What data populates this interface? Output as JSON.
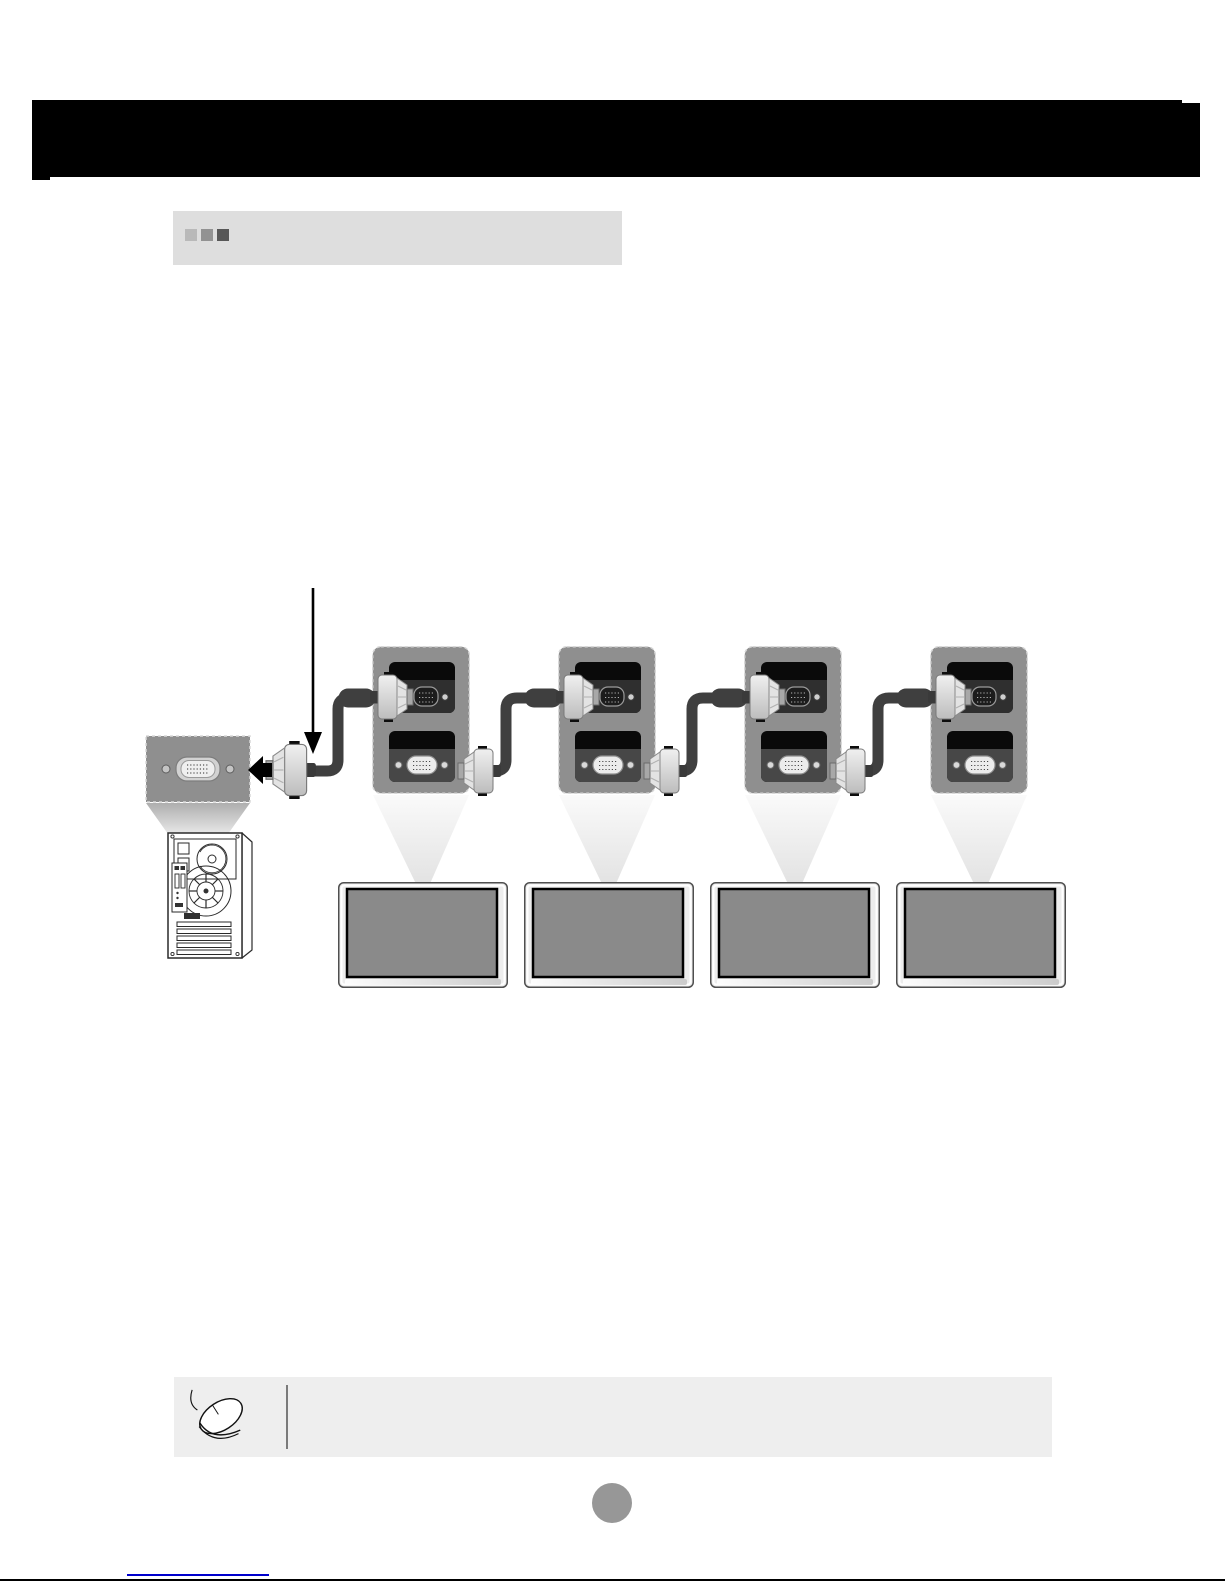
{
  "page": {
    "width": 1225,
    "height": 1585,
    "background": "#ffffff"
  },
  "header": {
    "title": "",
    "background": "#000000"
  },
  "section_heading": {
    "text": "",
    "background": "#dedede",
    "marker_squares": [
      "#b9b9b9",
      "#929292",
      "#575757"
    ]
  },
  "diagram": {
    "kind": "daisy-chain-connection-illustration",
    "source_device_icon": "pc-tower-rear",
    "display_count": 4,
    "chain_box_count": 4,
    "cable_connector_icon": "vga-dsub-connector",
    "colors": {
      "chain_box": "#8f8f8f",
      "chain_box_dash": "#d6d6d6",
      "cable": "#3f3f3f",
      "port_panel_dark": "#2f2f2f",
      "port_panel_mid": "#474747",
      "monitor_frame": "#ededed",
      "monitor_screen": "#8a8a8a",
      "arrow": "#000000"
    }
  },
  "note": {
    "text": "",
    "background": "#eeeeee",
    "icon": "mouse-icon",
    "divider_color": "#7a7a7a"
  },
  "page_number": {
    "label": "",
    "badge_color": "#979797"
  },
  "footer": {
    "link_text": "",
    "link_underline_color": "#0000cc"
  }
}
